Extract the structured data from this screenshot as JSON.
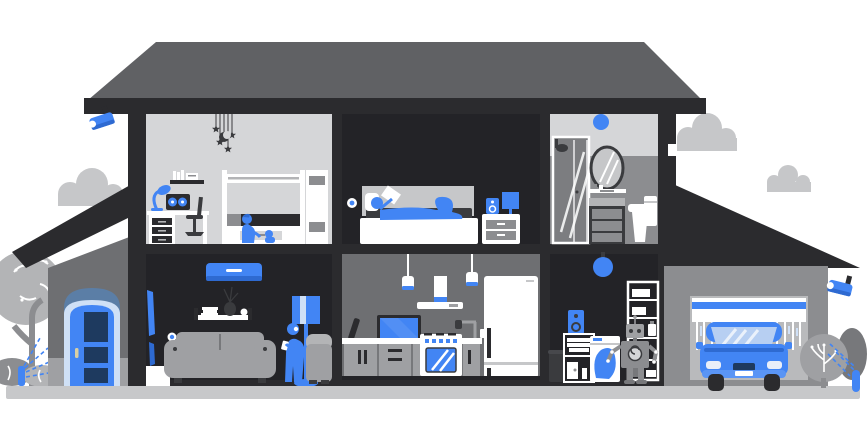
{
  "palette": {
    "accent": "#4285f4",
    "accentDark": "#2e6ad1",
    "accentSoft": "#5a95f5",
    "accentPale": "#cfe0f6",
    "navy": "#1e3a5f",
    "glass": "#b7cff2",
    "frame": "#2b2b2e",
    "dark": "#232327",
    "ink": "#3a3b3e",
    "roof": "#606164",
    "porch": "#6e6f72",
    "gray": "#8c8d90",
    "grayMid": "#9fa0a3",
    "grayLight": "#b3b4b6",
    "cloud": "#c6c7c9",
    "ground": "#c7c8ca",
    "roomLight": "#d5d6d8",
    "white": "#ffffff",
    "doorArch": "#5b7ea6",
    "handle": "#d8cfa4"
  },
  "scene": {
    "type": "smart-home cutaway illustration, no text rendered",
    "exterior": [
      "roof",
      "left-security-camera",
      "right-security-camera",
      "front-door-porch",
      "tree",
      "bushes",
      "left-sprinkler",
      "right-sprinkler",
      "clouds",
      "ground"
    ],
    "upstairs_rooms": [
      "kids-room",
      "bedroom",
      "bathroom"
    ],
    "downstairs_rooms": [
      "living-room",
      "kitchen",
      "utility-room",
      "garage"
    ],
    "smart_devices": [
      "security-camera",
      "ac-unit",
      "smart-sensor",
      "speaker",
      "smart-light",
      "robot-assistant",
      "washing-machine",
      "sprinkler",
      "connected-car"
    ]
  }
}
